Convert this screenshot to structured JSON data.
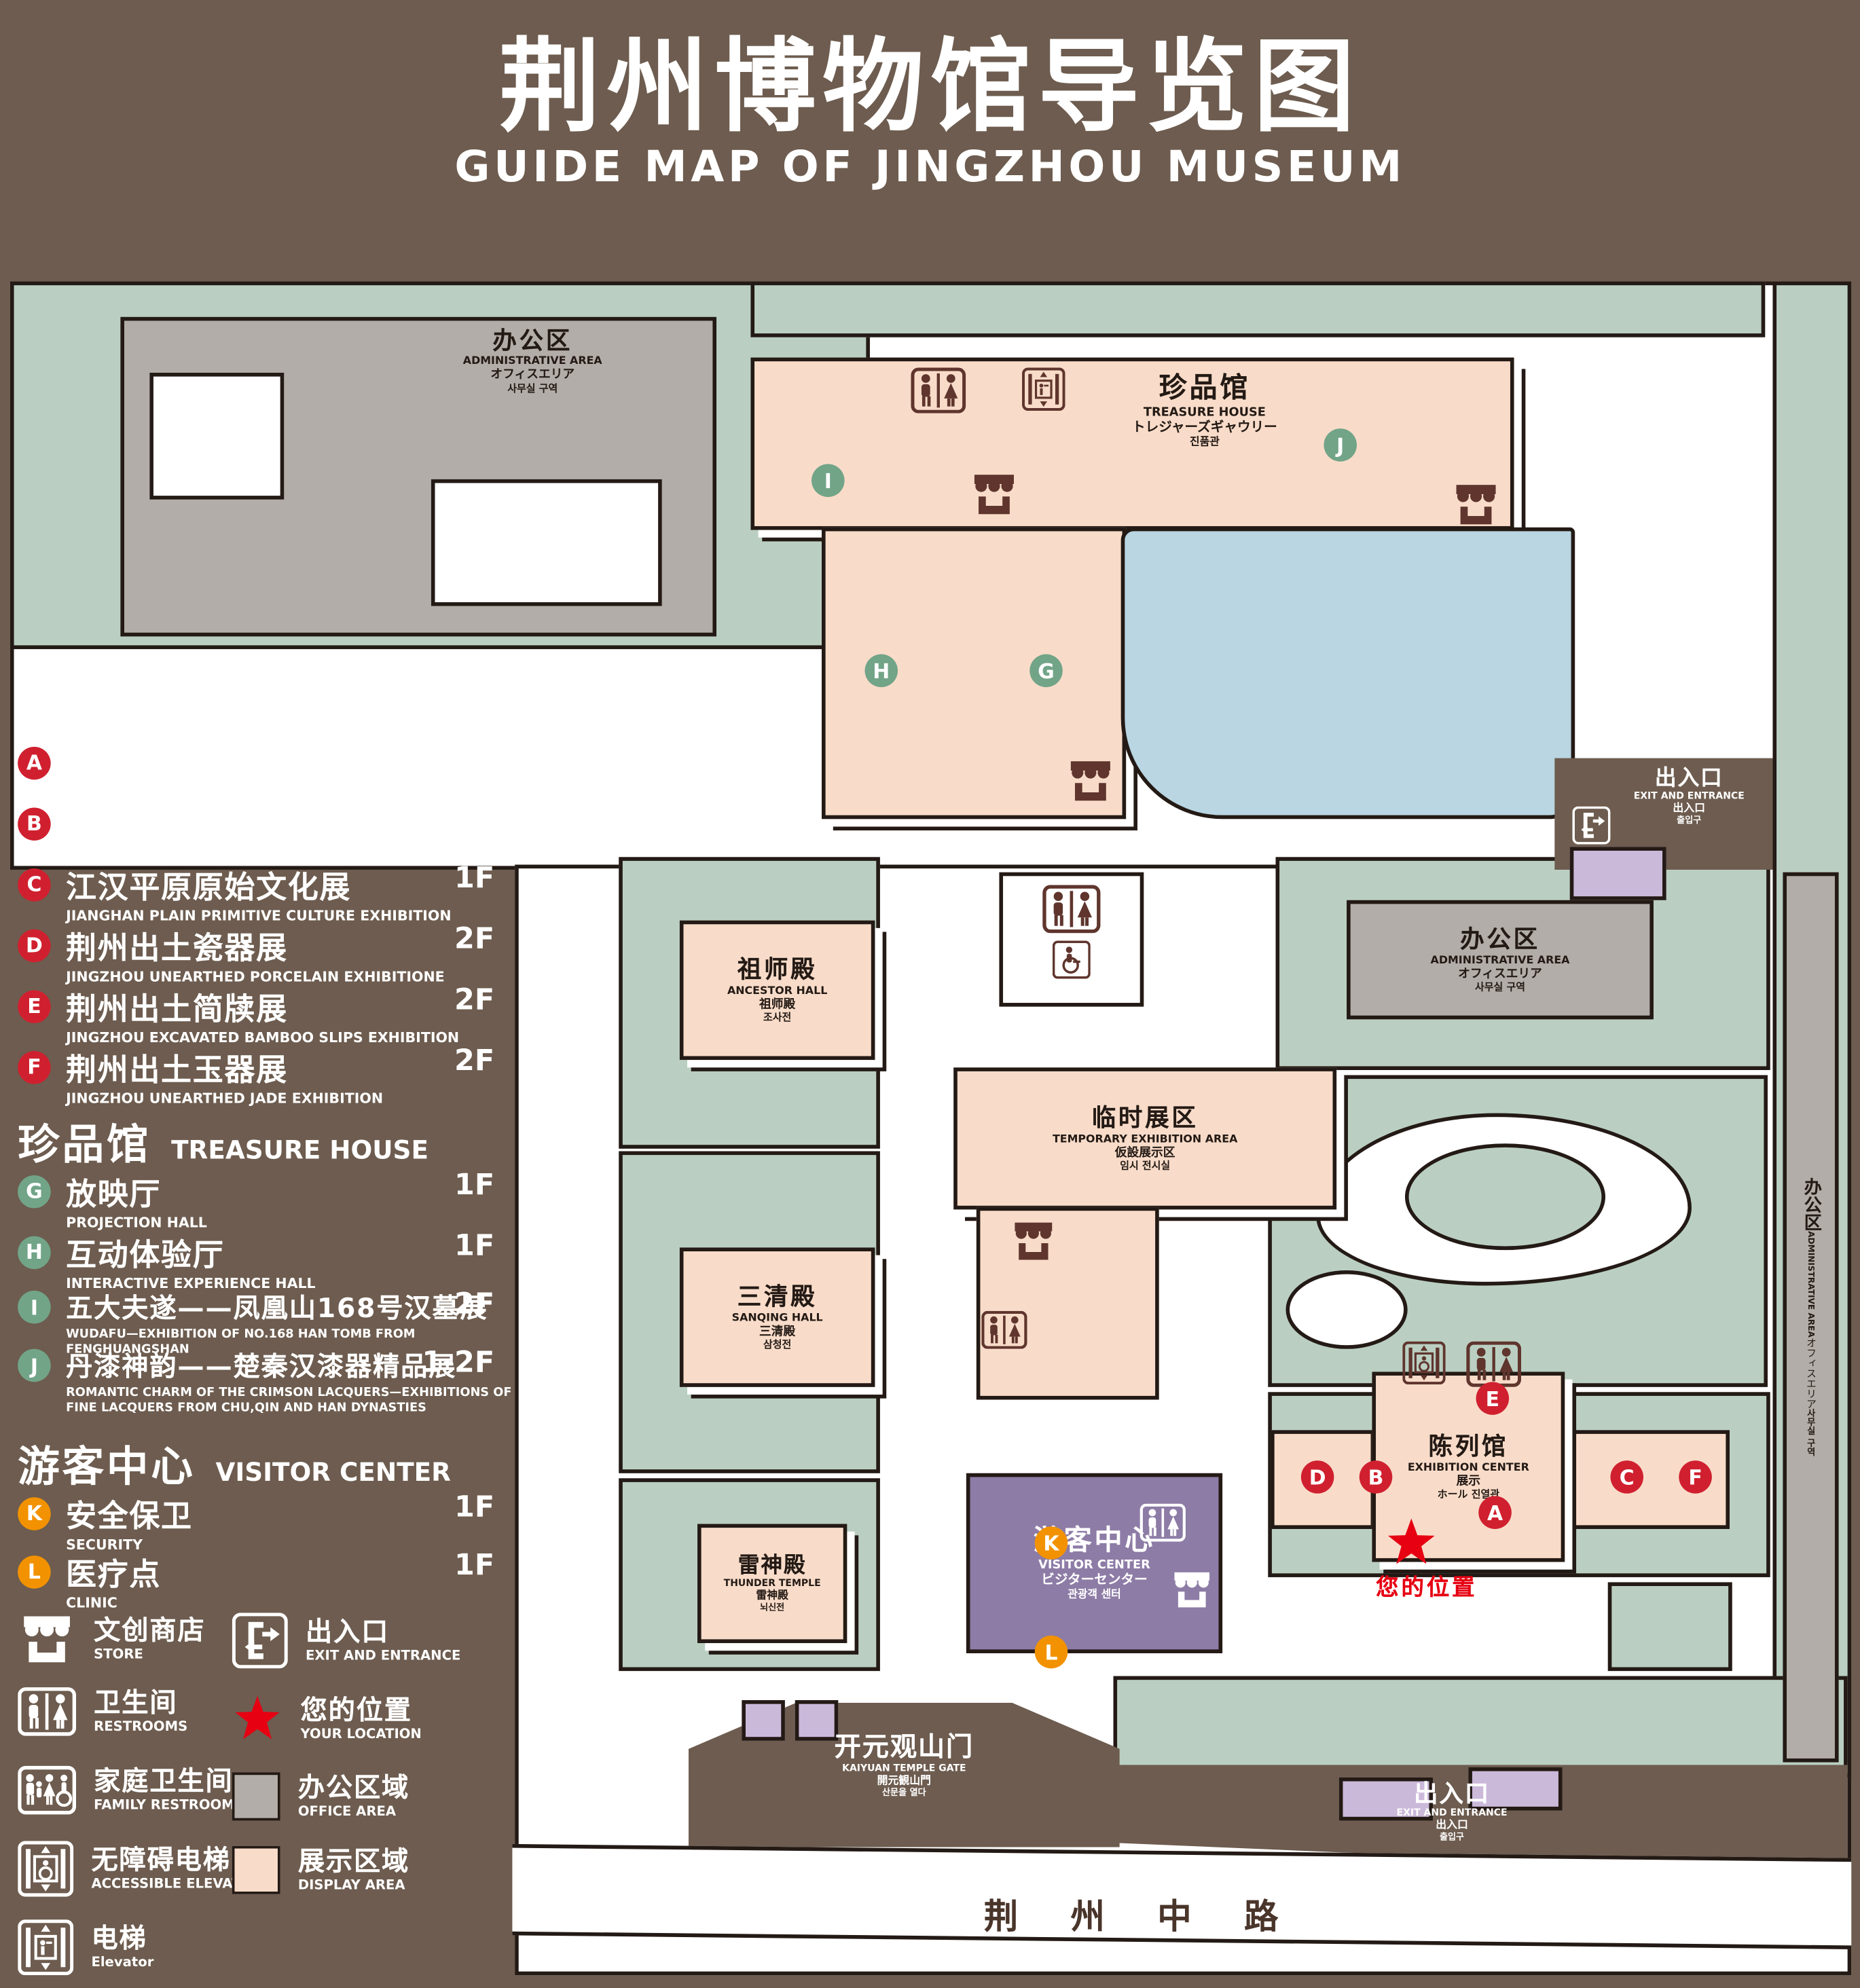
{
  "title": {
    "zh": "荆州博物馆导览图",
    "en": "GUIDE MAP OF JINGZHOU MUSEUM"
  },
  "legend": {
    "sections": [
      {
        "zh": "陈列馆",
        "en": "EXHIBITION CENTER",
        "items": [
          {
            "letter": "A",
            "zh": "《火中的凤凰》壁画",
            "en": "THE PHOENIX IN FIRE \"MURAL PAINTING",
            "floor": "1F"
          },
          {
            "letter": "B",
            "zh": "荆州出土铜器展",
            "en": "JINGZHOU UNEARTHED BRONZE WARE EXHIBITION",
            "floor": "1F"
          },
          {
            "letter": "C",
            "zh": "江汉平原原始文化展",
            "en": "JIANGHAN PLAIN PRIMITIVE CULTURE EXHIBITION",
            "floor": "1F"
          },
          {
            "letter": "D",
            "zh": "荆州出土瓷器展",
            "en": "JINGZHOU UNEARTHED PORCELAIN EXHIBITIONE",
            "floor": "2F"
          },
          {
            "letter": "E",
            "zh": "荆州出土简牍展",
            "en": "JINGZHOU EXCAVATED BAMBOO SLIPS EXHIBITION",
            "floor": "2F"
          },
          {
            "letter": "F",
            "zh": "荆州出土玉器展",
            "en": "JINGZHOU UNEARTHED JADE EXHIBITION",
            "floor": "2F"
          }
        ]
      },
      {
        "zh": "珍品馆",
        "en": "TREASURE HOUSE",
        "items": [
          {
            "letter": "G",
            "zh": "放映厅",
            "en": "PROJECTION HALL",
            "floor": "1F"
          },
          {
            "letter": "H",
            "zh": "互动体验厅",
            "en": "INTERACTIVE EXPERIENCE HALL",
            "floor": "1F"
          },
          {
            "letter": "I",
            "zh": "五大夫遂——凤凰山168号汉墓展",
            "en": "WUDAFU—EXHIBITION OF NO.168 HAN TOMB FROM FENGHUANGSHAN",
            "floor": "2F"
          },
          {
            "letter": "J",
            "zh": "丹漆神韵——楚秦汉漆器精品展",
            "en": "ROMANTIC CHARM OF THE CRIMSON LACQUERS—EXHIBITIONS OF FINE LACQUERS FROM CHU,QIN AND HAN DYNASTIES",
            "floor": "1-2F"
          }
        ]
      },
      {
        "zh": "游客中心",
        "en": "VISITOR CENTER",
        "items": [
          {
            "letter": "K",
            "zh": "安全保卫",
            "en": "SECURITY",
            "floor": "1F"
          },
          {
            "letter": "L",
            "zh": "医疗点",
            "en": "CLINIC",
            "floor": "1F"
          }
        ]
      }
    ],
    "symbols": [
      {
        "icon": "store-icon",
        "zh": "文创商店",
        "en": "STORE"
      },
      {
        "icon": "restrooms-icon",
        "zh": "卫生间",
        "en": "RESTROOMS"
      },
      {
        "icon": "family-restrooms-icon",
        "zh": "家庭卫生间",
        "en": "FAMILY RESTROOMS"
      },
      {
        "icon": "accessible-elevator-icon",
        "zh": "无障碍电梯",
        "en": "ACCESSIBLE ELEVATOR"
      },
      {
        "icon": "elevator-icon",
        "zh": "电梯",
        "en": "Elevator"
      },
      {
        "icon": "exit-icon",
        "zh": "出入口",
        "en": "EXIT AND ENTRANCE"
      },
      {
        "icon": "your-location-star",
        "zh": "您的位置",
        "en": "YOUR LOCATION"
      },
      {
        "icon": "office-area-swatch",
        "zh": "办公区域",
        "en": "OFFICE AREA"
      },
      {
        "icon": "display-area-swatch",
        "zh": "展示区域",
        "en": "DISPLAY AREA"
      }
    ]
  },
  "map": {
    "admin_tl": {
      "zh": "办公区",
      "en": "ADMINISTRATIVE AREA",
      "ja": "オフィスエリア",
      "ko": "사무실 구역"
    },
    "admin_mid": {
      "zh": "办公区",
      "en": "ADMINISTRATIVE AREA",
      "ja": "オフィスエリア",
      "ko": "사무실 구역"
    },
    "admin_side": {
      "zh": "办公区",
      "en": "ADMINISTRATIVE AREA",
      "ja": "オフィスエリア",
      "ko": "사무실 구역"
    },
    "treasure": {
      "zh": "珍品馆",
      "en": "TREASURE HOUSE",
      "ja": "トレジャーズギャウリー",
      "ko": "진품관"
    },
    "ancestor": {
      "zh": "祖师殿",
      "en": "ANCESTOR HALL",
      "ja": "祖师殿",
      "ko": "조사전"
    },
    "temporary": {
      "zh": "临时展区",
      "en": "TEMPORARY EXHIBITION AREA",
      "ja": "仮設展示区",
      "ko": "임시 전시실"
    },
    "sanqing": {
      "zh": "三清殿",
      "en": "SANQING HALL",
      "ja": "三清殿",
      "ko": "삼청전"
    },
    "thunder": {
      "zh": "雷神殿",
      "en": "THUNDER TEMPLE",
      "ja": "雷神殿",
      "ko": "뇌신전"
    },
    "visitor": {
      "zh": "游客中心",
      "en": "VISITOR CENTER",
      "ja": "ビジターセンター",
      "ko": "관광객 센터"
    },
    "exhibition": {
      "zh": "陈列馆",
      "en": "EXHIBITION CENTER",
      "ja": "展示",
      "ja2": "ホール",
      "ko": "진열관"
    },
    "gate": {
      "zh": "开元观山门",
      "en": "KAIYUAN TEMPLE GATE",
      "ja": "開元観山門",
      "ko": "산문을 열다"
    },
    "exit_east": {
      "zh": "出入口",
      "en": "EXIT AND ENTRANCE",
      "ja": "出入口",
      "ko": "출입구"
    },
    "exit_south": {
      "zh": "出入口",
      "en": "EXIT AND ENTRANCE",
      "ja": "出入口",
      "ko": "출입구"
    },
    "road": "荆 州 中 路",
    "your_location": "您的位置",
    "markers": {
      "A": "A",
      "B": "B",
      "C": "C",
      "D": "D",
      "E": "E",
      "F": "F",
      "G": "G",
      "H": "H",
      "I": "I",
      "J": "J",
      "K": "K",
      "L": "L"
    }
  },
  "colors": {
    "background_brown": "#6D5C4F",
    "outline": "#241A15",
    "lawn_green": "#BACFC2",
    "display_area_pink": "#F8DCC9",
    "office_area_gray": "#B2ADA8",
    "pond_blue": "#B9D6E2",
    "visitor_purple": "#8D7CA6",
    "gate_lavender": "#CBB9DA",
    "marker_red": "#D0202F",
    "marker_green": "#72A488",
    "marker_orange": "#F29200",
    "location_red": "#E60012",
    "icon_maroon": "#5F352D"
  }
}
